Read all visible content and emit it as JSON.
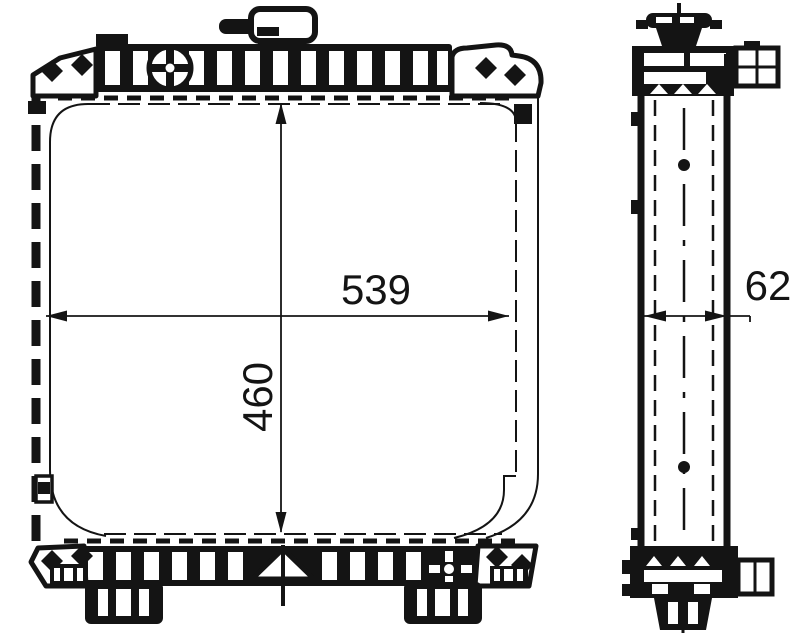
{
  "drawing_type": "radiator-technical-drawing",
  "colors": {
    "line": "#141414",
    "background": "#ffffff"
  },
  "dimensions": {
    "width": {
      "value": "539",
      "orientation": "horizontal",
      "view": "front"
    },
    "height": {
      "value": "460",
      "orientation": "vertical",
      "view": "front"
    },
    "depth": {
      "value": "62",
      "orientation": "horizontal",
      "view": "side"
    }
  },
  "marks": {
    "mounting_point_icon": "diamond",
    "boss_icon": "circle-cross",
    "center_datum_icon": "triangle-with-centerline"
  }
}
